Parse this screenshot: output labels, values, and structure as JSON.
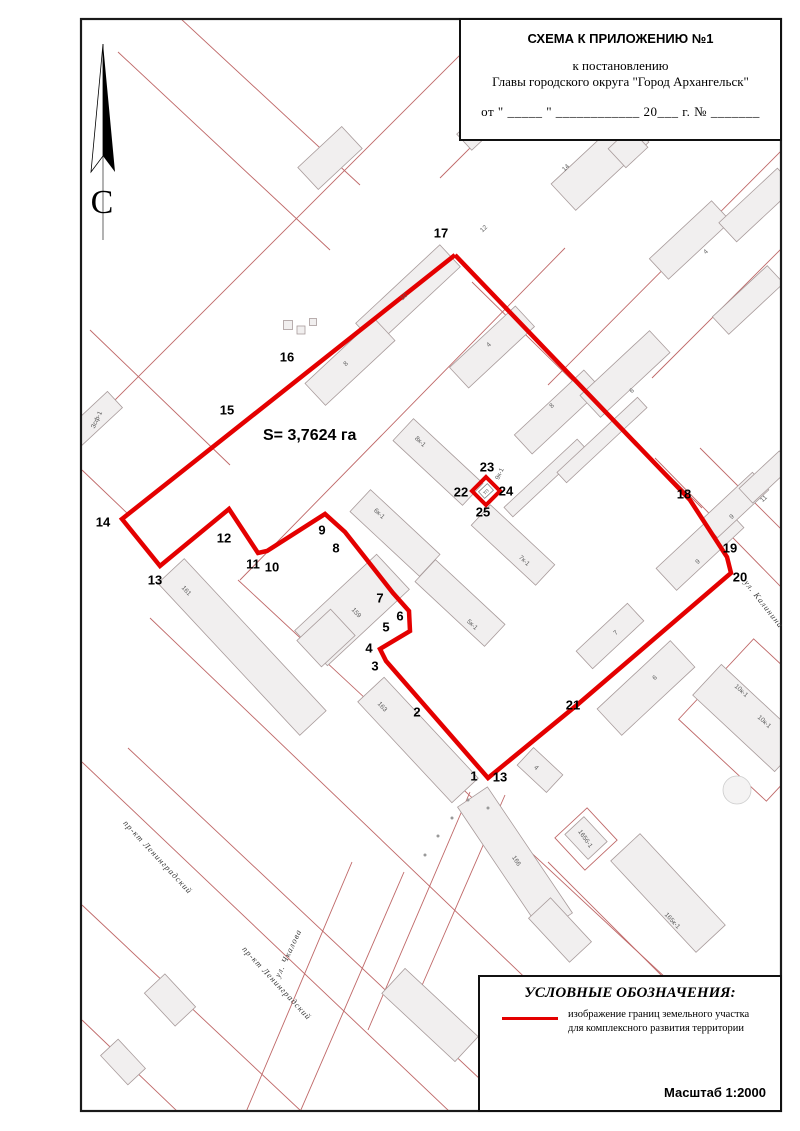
{
  "title_block": {
    "line1": "СХЕМА К ПРИЛОЖЕНИЮ №1",
    "line2": "к постановлению",
    "line3": "Главы городского округа \"Город Архангельск\"",
    "line4": "от \" _____ \" ____________ 20___  г. № _______"
  },
  "north_label": "С",
  "area_label": "S= 3,7624 га",
  "legend": {
    "title": "УСЛОВНЫЕ ОБОЗНАЧЕНИЯ:",
    "item1_line1": "изображение границ земельного участка",
    "item1_line2": "для комплексного развития территории",
    "scale": "Масштаб 1:2000"
  },
  "colors": {
    "boundary_red": "#e40000",
    "parcel_red": "#bf6868",
    "building_fill": "#f1efef",
    "building_stroke": "#a89b9b",
    "frame": "#1a1a1a"
  },
  "map": {
    "boundary": {
      "main_points": "455,255 690,500 727,557 731,573 577,705 488,778 386,661 380,649 410,631 409,611 393,593 345,532 325,514 267,551 258,553 229,509 160,566 122,519 455,255",
      "diamond_points": "486,477 500,491 486,505 472,491"
    },
    "point_labels": [
      {
        "text": "17",
        "x": 441,
        "y": 233
      },
      {
        "text": "16",
        "x": 287,
        "y": 357
      },
      {
        "text": "15",
        "x": 227,
        "y": 410
      },
      {
        "text": "14",
        "x": 103,
        "y": 522
      },
      {
        "text": "13",
        "x": 155,
        "y": 580
      },
      {
        "text": "12",
        "x": 224,
        "y": 538
      },
      {
        "text": "11",
        "x": 253,
        "y": 564
      },
      {
        "text": "10",
        "x": 272,
        "y": 567
      },
      {
        "text": "9",
        "x": 322,
        "y": 530
      },
      {
        "text": "8",
        "x": 336,
        "y": 548
      },
      {
        "text": "7",
        "x": 380,
        "y": 598
      },
      {
        "text": "6",
        "x": 400,
        "y": 616
      },
      {
        "text": "5",
        "x": 386,
        "y": 627
      },
      {
        "text": "4",
        "x": 369,
        "y": 648
      },
      {
        "text": "3",
        "x": 375,
        "y": 666
      },
      {
        "text": "2",
        "x": 417,
        "y": 712
      },
      {
        "text": "1",
        "x": 474,
        "y": 776
      },
      {
        "text": "13",
        "x": 500,
        "y": 777
      },
      {
        "text": "21",
        "x": 573,
        "y": 705
      },
      {
        "text": "20",
        "x": 740,
        "y": 577
      },
      {
        "text": "19",
        "x": 730,
        "y": 548
      },
      {
        "text": "18",
        "x": 684,
        "y": 494
      },
      {
        "text": "22",
        "x": 461,
        "y": 492
      },
      {
        "text": "23",
        "x": 487,
        "y": 467
      },
      {
        "text": "24",
        "x": 506,
        "y": 491
      },
      {
        "text": "25",
        "x": 483,
        "y": 512
      }
    ],
    "building_labels": [
      {
        "text": "10",
        "x": 404,
        "y": 297,
        "rot": -43
      },
      {
        "text": "8",
        "x": 346,
        "y": 364,
        "rot": -43
      },
      {
        "text": "12",
        "x": 484,
        "y": 229,
        "rot": -43
      },
      {
        "text": "4",
        "x": 489,
        "y": 345,
        "rot": -43
      },
      {
        "text": "8",
        "x": 552,
        "y": 406,
        "rot": -43
      },
      {
        "text": "6",
        "x": 632,
        "y": 391,
        "rot": -43
      },
      {
        "text": "14",
        "x": 566,
        "y": 168,
        "rot": -43
      },
      {
        "text": "4",
        "x": 706,
        "y": 252,
        "rot": -43
      },
      {
        "text": "9",
        "x": 698,
        "y": 562,
        "rot": -43
      },
      {
        "text": "9",
        "x": 732,
        "y": 517,
        "rot": -43
      },
      {
        "text": "11",
        "x": 764,
        "y": 499,
        "rot": -43
      },
      {
        "text": "6",
        "x": 655,
        "y": 678,
        "rot": -43
      },
      {
        "text": "7",
        "x": 616,
        "y": 633,
        "rot": -43
      },
      {
        "text": "8к-1",
        "x": 420,
        "y": 442,
        "rot": 43
      },
      {
        "text": "6к-1",
        "x": 379,
        "y": 514,
        "rot": 43
      },
      {
        "text": "7к-1",
        "x": 524,
        "y": 561,
        "rot": 43
      },
      {
        "text": "5к-1",
        "x": 472,
        "y": 625,
        "rot": 43
      },
      {
        "text": "9к-1",
        "x": 500,
        "y": 474,
        "rot": -65
      },
      {
        "text": "ТП",
        "x": 486,
        "y": 492,
        "rot": -43,
        "size": 4.5
      },
      {
        "text": "159",
        "x": 356,
        "y": 613,
        "rot": 47
      },
      {
        "text": "161",
        "x": 186,
        "y": 591,
        "rot": 47
      },
      {
        "text": "163",
        "x": 382,
        "y": 707,
        "rot": 47
      },
      {
        "text": "166",
        "x": 516,
        "y": 861,
        "rot": 56
      },
      {
        "text": "165к-1",
        "x": 672,
        "y": 921,
        "rot": 47
      },
      {
        "text": "165б-1",
        "x": 585,
        "y": 839,
        "rot": 55
      },
      {
        "text": "10к-1",
        "x": 741,
        "y": 691,
        "rot": 43
      },
      {
        "text": "10к-1",
        "x": 764,
        "y": 722,
        "rot": 43
      },
      {
        "text": "4",
        "x": 536,
        "y": 768,
        "rot": 43
      },
      {
        "text": "Зсф-1",
        "x": 97,
        "y": 420,
        "rot": -65
      }
    ],
    "street_labels": [
      {
        "text": "пр-кт Ленинградский",
        "x": 158,
        "y": 857,
        "rot": 47
      },
      {
        "text": "пр-кт Ленинградский",
        "x": 277,
        "y": 983,
        "rot": 47
      },
      {
        "text": "ул. Чкалова",
        "x": 288,
        "y": 953,
        "rot": -65
      },
      {
        "text": "ул. Калинина",
        "x": 764,
        "y": 604,
        "rot": 52
      }
    ]
  }
}
